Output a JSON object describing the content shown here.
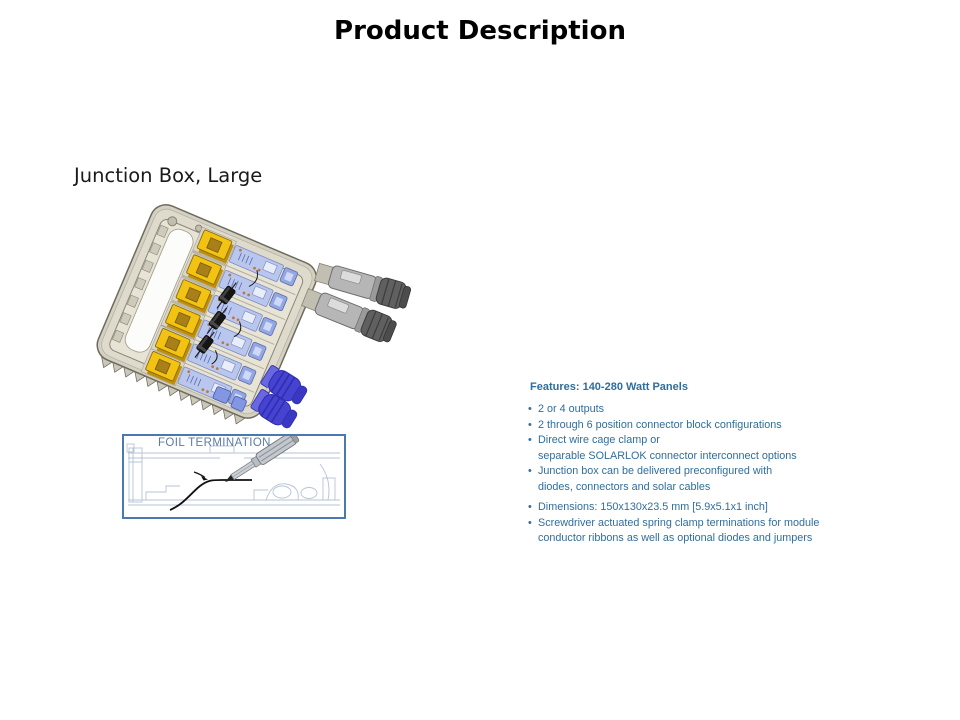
{
  "slide": {
    "title": "Product Description",
    "subtitle": "Junction Box, Large"
  },
  "foil_figure": {
    "label": "FOIL TERMINATION"
  },
  "features": {
    "heading": "Features: 140-280 Watt Panels",
    "bullet_char": "•",
    "items": [
      {
        "line1": "2 or 4 outputs",
        "line2": ""
      },
      {
        "line1": "2 through 6 position connector block configurations",
        "line2": ""
      },
      {
        "line1": "Direct wire cage clamp or",
        "line2": "separable SOLARLOK connector interconnect options"
      },
      {
        "line1": "Junction box can be delivered preconfigured with",
        "line2": "diodes, connectors and solar cables"
      },
      {
        "line1": "Dimensions: 150x130x23.5 mm [5.9x5.1x1 inch]",
        "line2": ""
      },
      {
        "line1": "Screwdriver actuated spring clamp terminations for module",
        "line2": "conductor ribbons as well as optional diodes and jumpers"
      }
    ]
  },
  "colors": {
    "features_text": "#2e6e9e",
    "foil_border": "#4a78b0",
    "foil_label_text": "#5b7ca8",
    "case_beige": "#d5d1c2",
    "clamp_yellow": "#f2c313",
    "circuit_block_blue": "#b9c7ee",
    "cable_gland_blue": "#4543cf",
    "connector_gray": "#b4b4b4",
    "title_text": "#000000"
  }
}
